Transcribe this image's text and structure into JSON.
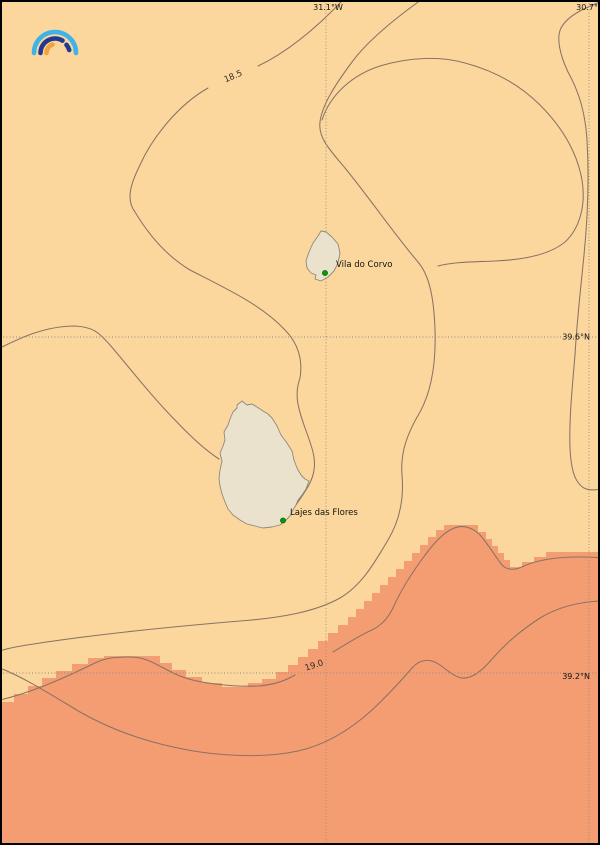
{
  "map": {
    "grid": {
      "meridians": [
        {
          "label": "31.1°W"
        },
        {
          "label": "30.7°W"
        }
      ],
      "parallels": [
        {
          "label": "39.6°N"
        },
        {
          "label": "39.2°N"
        }
      ]
    },
    "contour_labels": [
      {
        "text": "18.5"
      },
      {
        "text": "19.0"
      }
    ],
    "places": [
      {
        "name": "Vila do Corvo"
      },
      {
        "name": "Lajes das Flores"
      }
    ]
  },
  "map_data": {
    "type": "isoline-temperature-map",
    "isoline_levels_visible": [
      18.5,
      19.0
    ],
    "longitude_ticks_deg_w": [
      31.1,
      30.7
    ],
    "latitude_ticks_deg_n": [
      39.6,
      39.2
    ],
    "warm_region": "southern band above 19.0 shown as darker orange raster with stepped edge",
    "markers": [
      "Vila do Corvo",
      "Lajes das Flores"
    ]
  },
  "colors": {
    "sea_light": "#fbd79e",
    "sea_warm": "#f49d72",
    "land": "#eae2cc",
    "land_edge": "#8f887a",
    "contour": "#8a7363",
    "contour_label": "#2e2a26",
    "grid": "#8f8a82",
    "label": "#111111",
    "frame": "#000000",
    "marker": "#00a000",
    "marker_edge": "#005200",
    "logo_blue": "#3fb3e8",
    "logo_navy": "#23398f",
    "logo_orange": "#f2a33c"
  }
}
